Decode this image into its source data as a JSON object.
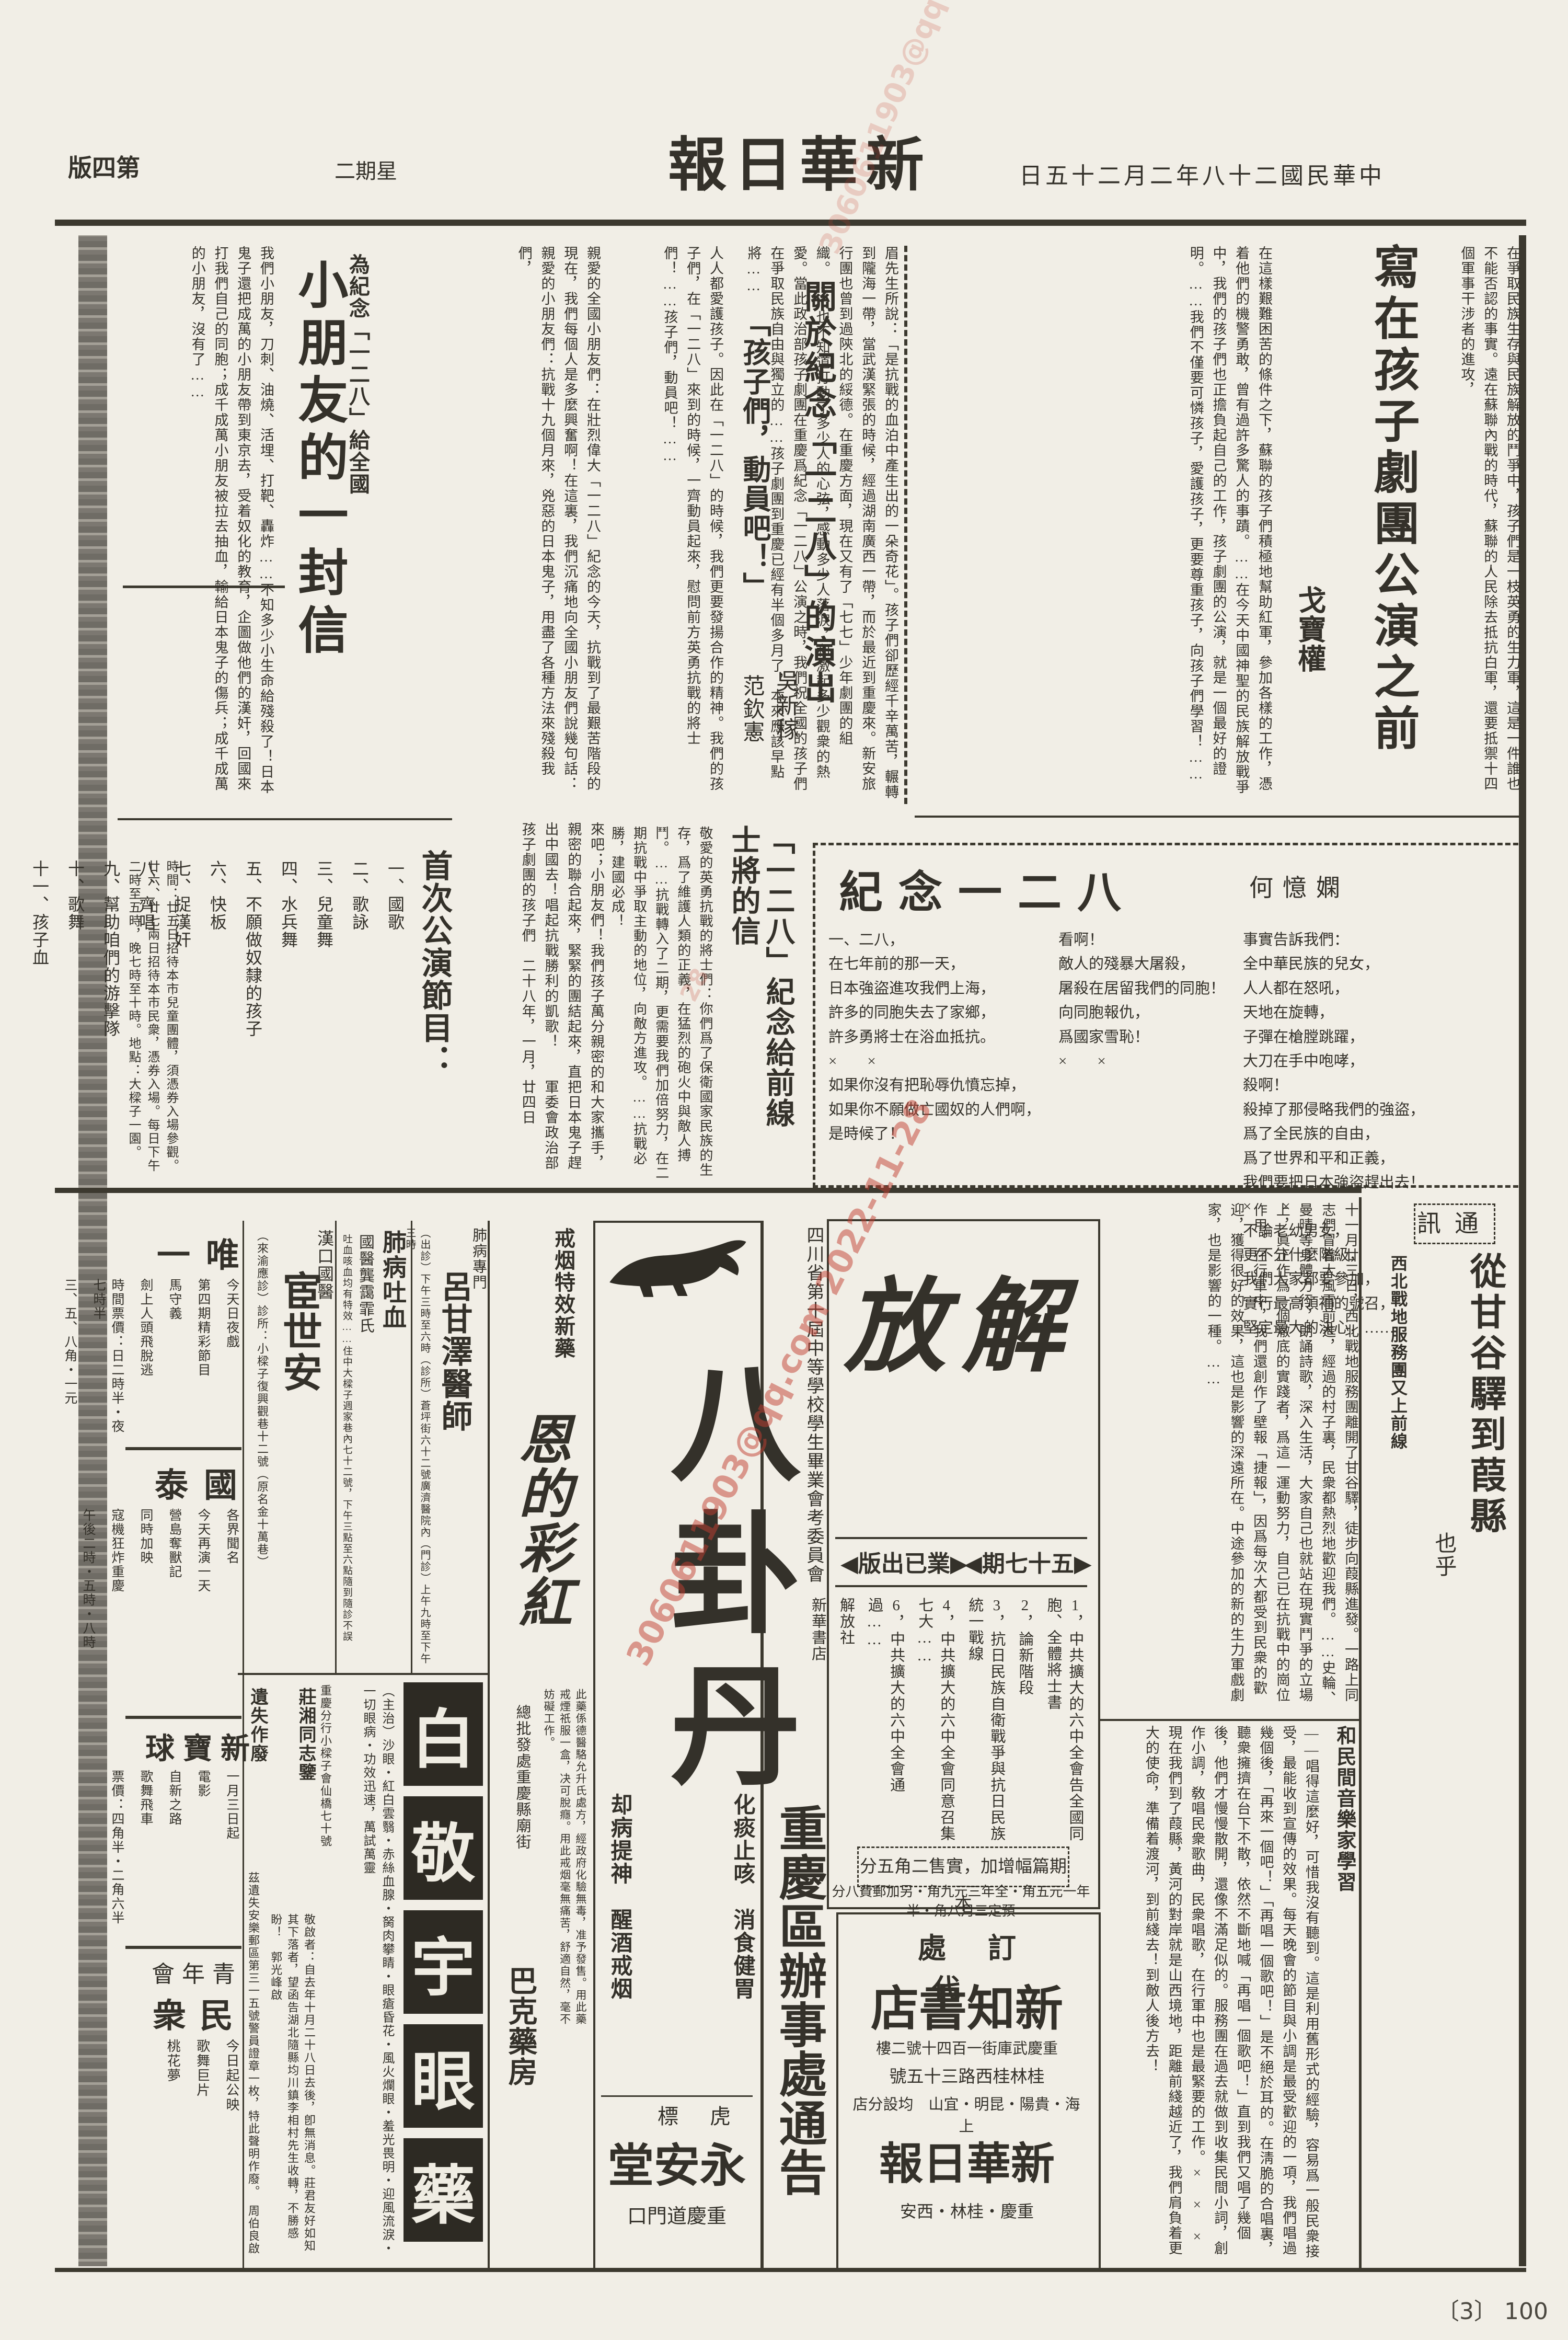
{
  "masthead": {
    "title": "新華日報",
    "date": "中華民國二十八年二月二十五日",
    "weekday": "星期二",
    "edition": "第四版"
  },
  "archive": {
    "page_label": "〔3〕 100"
  },
  "watermark": {
    "text": "3060611903@qq.com 2022-11-28",
    "fragment": "28"
  },
  "article_troupe": {
    "title": "寫在孩子劇團公演之前",
    "author": "戈寶權",
    "body_a": "在爭取民族生存與民族解放的鬥爭中，孩子們是一枝英勇的生力軍，這是一件誰也不能否認的事實。遠在蘇聯內戰的時代，蘇聯的人民除去抵抗白軍，還要抵禦十四個軍事干涉者的進攻，",
    "body_b": "在這樣艱難困苦的條件之下，蘇聯的孩子們積極地幫助紅軍，參加各樣的工作，憑着他們的機警勇敢，曾有過許多驚人的事蹟。……在今天中國神聖的民族解放戰爭中，我們的孩子們也正擔負起自己的工作，孩子劇團的公演，就是一個最好的證明。……我們不僅要可憐孩子，愛護孩子，更要尊重孩子，向孩子們學習！……"
  },
  "article_performance": {
    "title": "關於紀念「一二八」的演出",
    "author": "吳新稼",
    "body": "眉先生所說：「是抗戰的血泊中產生出的一朵奇花」。孩子們卻歷經千辛萬苦，輾轉到隴海一帶，當武漢緊張的時候，經過湖南廣西一帶，而於最近到重慶來。新安旅行團也曾到過陝北的綏德。在重慶方面，現在又有了「七七」少年劇團的組織。……也不知道打動了多少人的心弦，感動多少人落淚，和激起多少觀衆的熱愛。當此政治部孩子劇團在重慶爲紀念「一二八」公演之時，我們祝全國的孩子們在爭取民族自由與獨立的……孩子劇團到重慶已經有半個多月了，本來應該早點將……"
  },
  "article_mobilize": {
    "title": "「孩子們，動員吧！」",
    "author": "范欽憲",
    "body": "人人都愛護孩子。因此在「一二八」的時候，我們更要發揚合作的精神。我們的孩子們，在「一二八」來到的時候，一齊動員起來，慰問前方英勇抗戰的將士們！……孩子們，動員吧！……"
  },
  "article_letter": {
    "kicker": "為紀念「一二八」給全國",
    "title": "小朋友的一封信",
    "body1": "親愛的全國小朋友們：在壯烈偉大「一二八」紀念的今天，抗戰到了最艱苦階段的現在，我們每個人是多麼興奮啊！在這裏，我們沉痛地向全國小朋友們說幾句話：親愛的小朋友們：抗戰十九個月來，兇惡的日本鬼子，用盡了各種方法來殘殺我們，",
    "body2": "我們小朋友，刀刺、油燒、活埋、打靶、轟炸……不知多少小生命給殘殺了！日本鬼子還把成萬的小朋友帶到東京去，受着奴化的教育，企圖做他們的漢奸，回國來打我們自己的同胞；成千成萬小朋友被拉去抽血，輸給日本鬼子的傷兵；成千成萬的小朋友，沒有了……",
    "cont": "來吧；小朋友們！我們孩子萬分親密的和大家攜手，親密的聯合起來，緊緊的團結起來，直把日本鬼子趕出中國去！唱起抗戰勝利的凱歌！　　軍委會政治部孩子劇團的孩子們　二十八年，一月，廿四日"
  },
  "article_frontline": {
    "title1": "「一二八」紀念給前線",
    "title2": "士將的信",
    "body": "敬愛的英勇抗戰的將士們：你們爲了保衛國家民族的生存，爲了維護人類的正義，在猛烈的砲火中與敵人搏鬥。……抗戰轉入了二期，更需要我們加倍努力，在二期抗戰中爭取主動的地位，向敵方進攻。……抗戰必勝，建國必成！"
  },
  "poem": {
    "title": "紀念一二八",
    "author": "何憶嫻",
    "cols": [
      [
        "一、二八，",
        "在七年前的那一天，",
        "日本強盜進攻我們上海，",
        "許多的同胞失去了家鄉，",
        "許多勇將士在浴血抵抗。",
        "×　　×",
        "如果你沒有把恥辱仇憤忘掉，",
        "如果你不願做亡國奴的人們啊，",
        "是時候了！"
      ],
      [
        "看啊！",
        "敵人的殘暴大屠殺，",
        "屠殺在居留我們的同胞！",
        "向同胞報仇，",
        "爲國家雪恥！",
        "×　　×"
      ],
      [
        "事實告訴我們：",
        "全中華民族的兒女，",
        "人人都在怒吼，",
        "天地在旋轉，",
        "子彈在槍膛跳躍，",
        "大刀在手中咆哮，",
        "殺啊！",
        "殺掉了那侵略我們的強盜，",
        "爲了全民族的自由，",
        "爲了世界和平和正義，",
        "我們要把日本強盜趕出去！",
        "×　　×",
        "不論老幼男女，",
        "更不分什麼階級，",
        "我們大家都要參加，",
        "實行最高領袖的號召，",
        "堅定最大的決心，……"
      ]
    ]
  },
  "program": {
    "title": "首次公演節目：",
    "items": [
      "一、國歌",
      "二、歌詠",
      "三、兒童舞",
      "四、水兵舞",
      "五、不願做奴隸的孩子",
      "六、快板",
      "七、捉漢奸",
      "八、齊唱",
      "九、幫助咱們的游擊隊",
      "十、歌舞",
      "十一、孩子血"
    ],
    "note": "時間：廿五日招待本市兒童團體，須憑券入場參觀。廿六、廿七兩日招待本市民衆，憑券入場。每日下午二時至五時，晚七時至十時。地點：大樑子一園。"
  },
  "correspondence": {
    "label": "通訊",
    "title": "從甘谷驛到葭縣",
    "author": "也乎",
    "subhead": "西北戰地服務團又上前線",
    "subhead2": "和民間音樂家學習",
    "body1": "十一月廿三日，西北戰地服務團離開了甘谷驛，徒步向葭縣進發。一路上同志們冒着大風雪前進，經過的村子裏，民衆都熱烈地歡迎我們。……史輪、曼晴等身體力行，朗誦詩歌，深入生活，大家自己也就站在現實鬥爭的立場上，眞正作爲一個澈底的實踐者，爲這一運動努力，自己已在抗戰中的崗位作用。在行軍中，我們還創作了壁報「捷報」，因爲每次大都受到民衆的歡迎，獲得很好的效果，這也是影響的深遠所在。中途參加的新的生力軍戲劇家，也是影響的一種。……",
    "body2": "——唱得這麼好，可惜我沒有聽到。這是利用舊形式的經驗，容易爲一般民衆接受，最能收到宣傳的效果。每天晚會的節目與小調是最受歡迎的一項，我們唱過幾個後，「再來一個吧！」「再唱一個歌吧！」是不絕於耳的。在淸脆的合唱裏，聽衆擁擠在台下不散，依然不斷地喊「再唱一個歌吧！」直到我們又唱了幾個後，他們才慢慢散開，還像不滿足似的。服務團在過去就做到收集民間小詞，創作小調，敎唱民衆歌曲，民衆唱歌，在行軍中也是最緊要的工作。×　×　×　現在我們到了葭縣，黃河的對岸就是山西境地，距離前綫越近了，我們肩負着更大的使命，準備着渡河，到前綫去！到敵人後方去！"
  },
  "jiefang": {
    "name": "解放",
    "issue": "▶五十七期◀",
    "status": "▶業已出版◀",
    "contents": [
      "1，中共擴大的六中全會告全國同胞、全體將士書",
      "2，論新階段",
      "3，抗日民族自衛戰爭與抗日民族統一戰線",
      "4，中共擴大的六中全會同意召集七大……",
      "6，中共擴大的六中全會通過……",
      "解放社",
      "新華書店"
    ],
    "note": "本期篇幅增加，實售二角五分",
    "prices": "預定三月八角・半年一元五角・全年三元九角・另加郵費八分"
  },
  "sichuan": {
    "org": "四川省第十屆中等學校學生畢業會考委員會",
    "office": "重慶區辦事處通告"
  },
  "bagua": {
    "name": "八卦丹",
    "line1": "化痰止咳　消食健胃",
    "line2": "却病提神　醒酒戒烟",
    "brand": "虎標",
    "store": "永安堂",
    "address": "重慶道門口"
  },
  "jieyan": {
    "kicker": "戒烟特效新藥",
    "name": "恩的彩紅",
    "body": "此藥係德醫駱允升氏處方，經政府化驗無毒，准予發售。用此藥戒煙祇服一盒，决可脫癮。用此戒烟毫無痛苦，舒適自然，毫不妨礙工作。",
    "dist": "總批發處重慶縣廟街",
    "store": "巴克藥房"
  },
  "eyemed": {
    "chars": [
      "白",
      "敬",
      "宇",
      "眼",
      "藥"
    ],
    "indications": "（主治）沙眼・紅白雲翳・赤絲血腺・胬肉攀睛・眼瘡昏花・風火爛眼・羞光畏明・迎風流淚・一切眼病・功效迅速，萬試萬靈",
    "branch": "重慶分行小樑子會仙橋七十號"
  },
  "doctor_lu": {
    "kicker": "肺病專門",
    "name": "呂甘澤醫師",
    "info": "（出診）下午三時至六時（診所）蒼坪街六十二號廣濟醫院內（門診）上午九時至下午三時"
  },
  "doctor_gong": {
    "title": "肺病吐血",
    "name": "國醫龔靄霏氏",
    "info": "吐血咳血均有特效……住中大樑子週家巷內七十二號，下午三點至六點隨到隨診不誤"
  },
  "doctor_huan": {
    "kicker": "漢口國醫",
    "name": "宦世安",
    "info": "（來渝應診）診所：小樑子復興觀巷十二號（原名金十萬巷）"
  },
  "theater_weiyi": {
    "name": "唯一",
    "lines": [
      "今天日夜戲",
      "第四期精彩節目",
      "馬守義",
      "劍上人頭飛脫逃",
      "時間票價：日二時半・夜七時半",
      "三、五、八角・一元"
    ]
  },
  "theater_guotai": {
    "name": "國泰",
    "lines": [
      "各界聞名",
      "今天再演一天",
      "營島奪獸記",
      "同時加映",
      "寇機狂炸重慶",
      "午後二時・五時・八時"
    ]
  },
  "theater_xinbaoqiu": {
    "name": "新寶球",
    "lines": [
      "一月三日起",
      "電影",
      "自新之路",
      "歌舞飛車",
      "票價：四角半・二角六半"
    ]
  },
  "theater_minzhong": {
    "venue": "青年會",
    "name": "民衆",
    "lines": [
      "今日起公映",
      "歌舞巨片",
      "桃花夢"
    ]
  },
  "notice_zhuang": {
    "title": "莊湘同志鑒",
    "body": "敬啟者：自去年十月二十八日去後，卽無消息。莊君友好如知其下落者，望函告湖北隨縣均川鎮李相村先生收轉，不勝感盼！　郭光峰啟"
  },
  "notice_lost": {
    "title": "遺失作廢",
    "body": "茲遺失安樂郵區第三一五號警員證章一枚，特此聲明作廢。　周伯良啟"
  },
  "xinzhi": {
    "label": "代訂處",
    "name": "新知書店",
    "addr1": "重慶武庫街一百四十號二樓",
    "addr2": "桂林桂西路三十五號",
    "branches": "上海・貴陽・昆明・宜山　均設分店",
    "paper": "新華日報",
    "cities": "重慶・桂林・西安"
  }
}
